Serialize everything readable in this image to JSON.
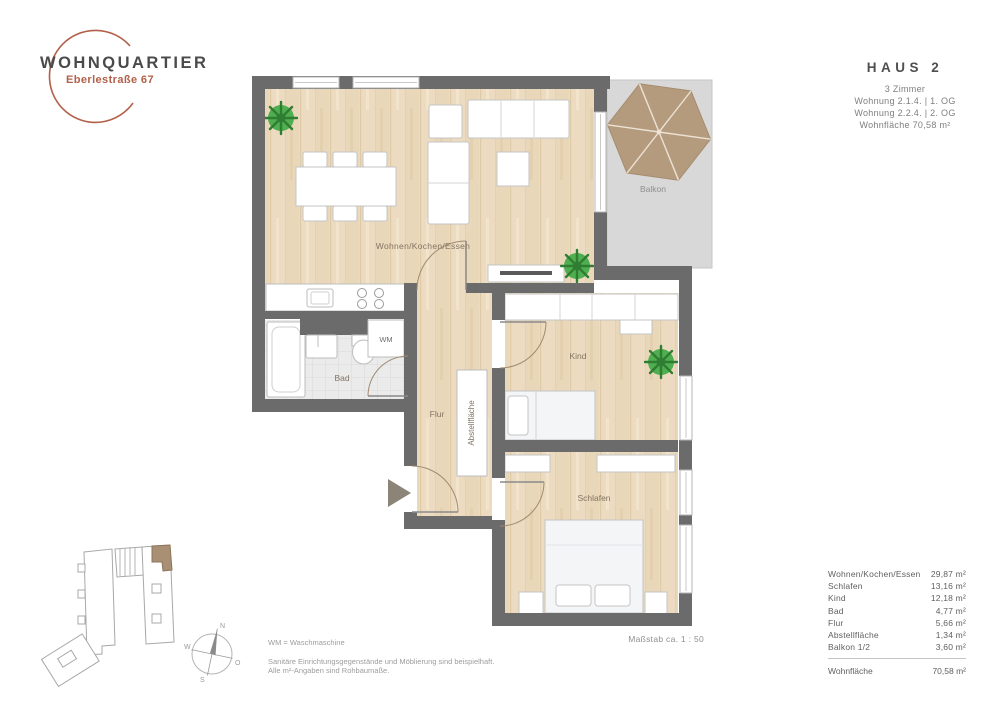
{
  "logo": {
    "title": "WOHNQUARTIER",
    "subtitle": "Eberlestraße 67"
  },
  "haus_info": {
    "title": "HAUS 2",
    "rooms": "3 Zimmer",
    "unit1": "Wohnung 2.1.4. | 1. OG",
    "unit2": "Wohnung 2.2.4. | 2. OG",
    "area": "Wohnfläche 70,58 m²"
  },
  "plan": {
    "labels": {
      "living": "Wohnen/Kochen/Essen",
      "balcony": "Balkon",
      "bad": "Bad",
      "wm": "WM",
      "flur": "Flur",
      "storage": "Abstellfläche",
      "kind": "Kind",
      "schlafen": "Schlafen"
    }
  },
  "compass": {
    "n": "N",
    "w": "W",
    "o": "O",
    "s": "S"
  },
  "scale_note": "Maßstab ca. 1 : 50",
  "notes": {
    "wm": "WM = Waschmaschine",
    "line1": "Sanitäre Einrichtungsgegenstände und Möblierung sind beispielhaft.",
    "line2": "Alle m²-Angaben sind Rohbaumaße."
  },
  "area_table": {
    "rows": [
      {
        "label": "Wohnen/Kochen/Essen",
        "value": "29,87 m²"
      },
      {
        "label": "Schlafen",
        "value": "13,16 m²"
      },
      {
        "label": "Kind",
        "value": "12,18 m²"
      },
      {
        "label": "Bad",
        "value": "4,77 m²"
      },
      {
        "label": "Flur",
        "value": "5,66 m²"
      },
      {
        "label": "Abstellfläche",
        "value": "1,34 m²"
      },
      {
        "label": "Balkon 1/2",
        "value": "3,60 m²"
      }
    ],
    "total": {
      "label": "Wohnfläche",
      "value": "70,58 m²"
    }
  },
  "colors": {
    "brand_terracotta": "#b2604a",
    "wall_gray": "#6b6b6b",
    "wood_floor": "#ecdbc0",
    "tile_gray": "#ebebeb",
    "balcony_gray": "#d8d8d8",
    "highlight_unit_brown": "#a98f73",
    "plant_green": "#4fae4f",
    "umbrella_tan": "#b59b7d"
  }
}
